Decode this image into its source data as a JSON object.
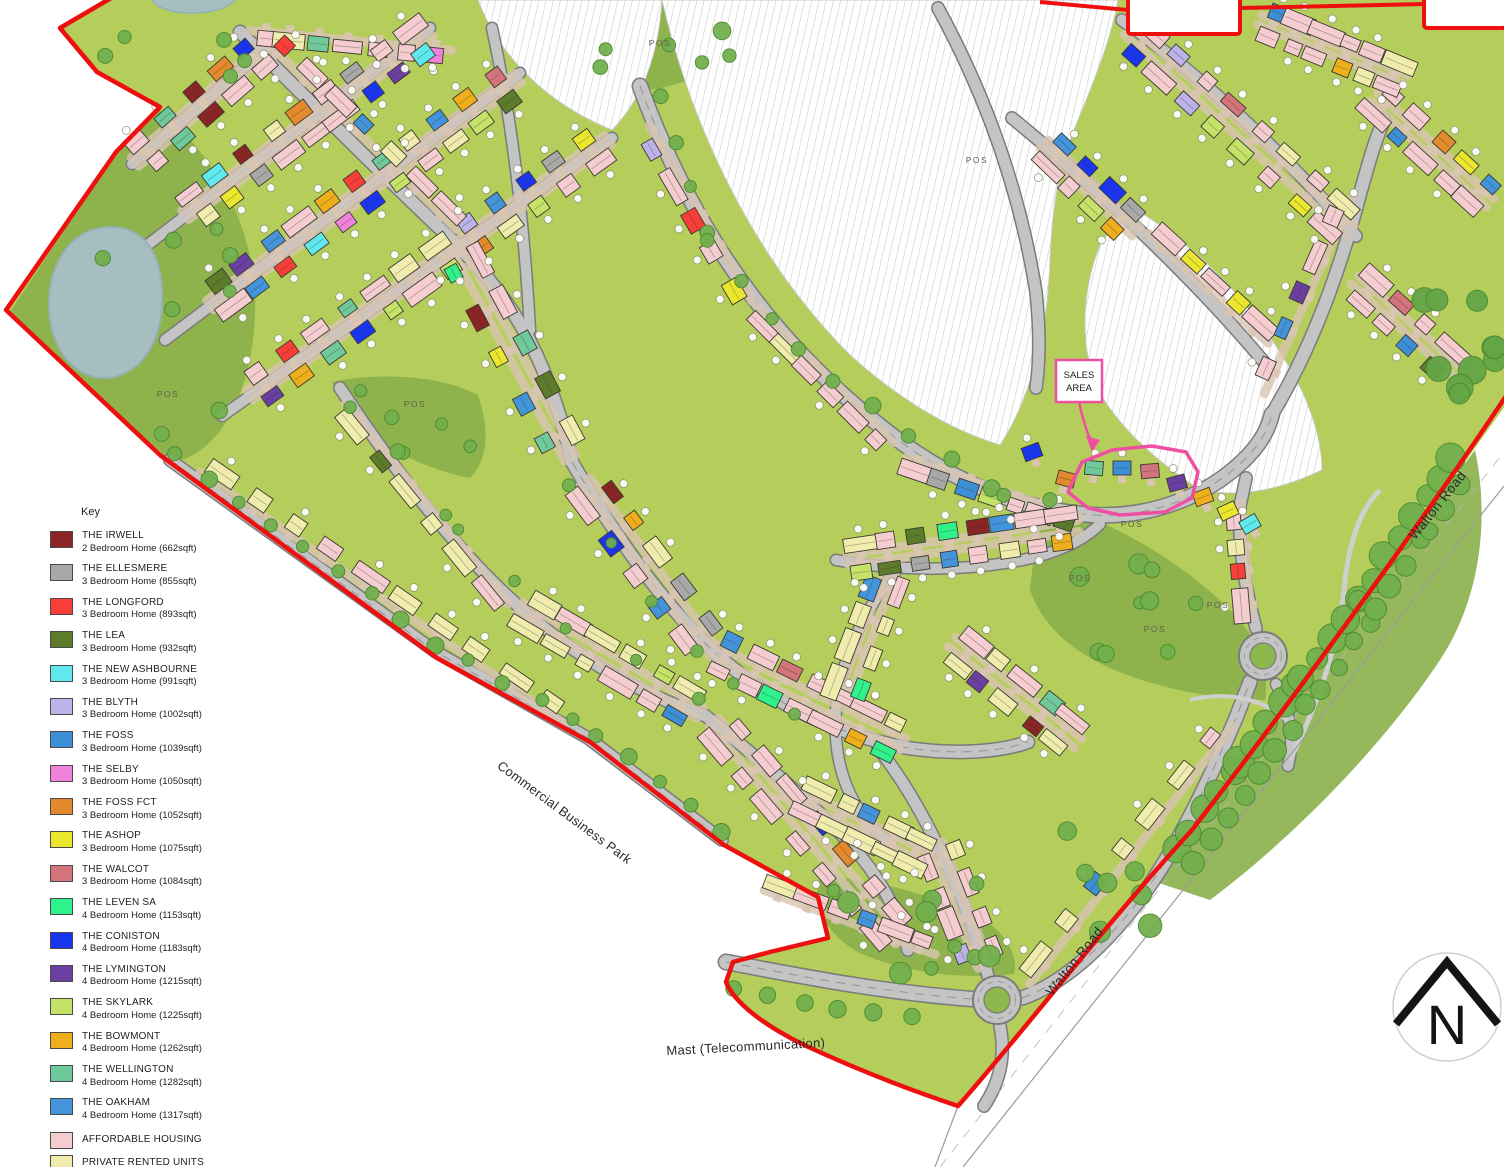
{
  "legend": {
    "title": "Key",
    "items": [
      {
        "name": "THE IRWELL",
        "desc": "2 Bedroom Home (662sqft)",
        "color": "#8b2424"
      },
      {
        "name": "THE ELLESMERE",
        "desc": "3 Bedroom Home (855sqft)",
        "color": "#a8a8a8"
      },
      {
        "name": "THE LONGFORD",
        "desc": "3 Bedroom Home (893sqft)",
        "color": "#f83e38"
      },
      {
        "name": "THE LEA",
        "desc": "3 Bedroom Home (932sqft)",
        "color": "#5d7c2b"
      },
      {
        "name": "THE NEW ASHBOURNE",
        "desc": "3 Bedroom Home (991sqft)",
        "color": "#5fe9ef"
      },
      {
        "name": "THE BLYTH",
        "desc": "3 Bedroom Home (1002sqft)",
        "color": "#bdb2e9"
      },
      {
        "name": "THE FOSS",
        "desc": "3 Bedroom Home (1039sqft)",
        "color": "#3c8ed6"
      },
      {
        "name": "THE SELBY",
        "desc": "3 Bedroom Home (1050sqft)",
        "color": "#ee82dc"
      },
      {
        "name": "THE FOSS FCT",
        "desc": "3 Bedroom Home (1052sqft)",
        "color": "#e4892d"
      },
      {
        "name": "THE ASHOP",
        "desc": "3 Bedroom Home (1075sqft)",
        "color": "#ebe72e"
      },
      {
        "name": "THE WALCOT",
        "desc": "3 Bedroom Home (1084sqft)",
        "color": "#d3737c"
      },
      {
        "name": "THE LEVEN SA",
        "desc": "4 Bedroom Home (1153sqft)",
        "color": "#2ff28c"
      },
      {
        "name": "THE CONISTON",
        "desc": "4 Bedroom Home (1183sqft)",
        "color": "#1a35f0"
      },
      {
        "name": "THE LYMINGTON",
        "desc": "4 Bedroom Home (1215sqft)",
        "color": "#6b3fa2"
      },
      {
        "name": "THE SKYLARK",
        "desc": "4 Bedroom Home (1225sqft)",
        "color": "#c6e369"
      },
      {
        "name": "THE BOWMONT",
        "desc": "4 Bedroom Home (1262sqft)",
        "color": "#efae1c"
      },
      {
        "name": "THE WELLINGTON",
        "desc": "4 Bedroom Home (1282sqft)",
        "color": "#6fc99b"
      },
      {
        "name": "THE OAKHAM",
        "desc": "4 Bedroom Home (1317sqft)",
        "color": "#4494dc"
      },
      {
        "name": "AFFORDABLE HOUSING",
        "desc": "",
        "color": "#f5cdd1"
      },
      {
        "name": "PRIVATE RENTED UNITS",
        "desc": "",
        "color": "#f0ecae"
      }
    ]
  },
  "labels": {
    "sales_area": "SALES AREA",
    "north": "N"
  },
  "map_labels": [
    {
      "id": "pos-1",
      "text": "POS",
      "x": 660,
      "y": 46,
      "rot": 0,
      "cls": "pos"
    },
    {
      "id": "pos-2",
      "text": "POS",
      "x": 977,
      "y": 163,
      "rot": 0,
      "cls": "pos"
    },
    {
      "id": "pos-3",
      "text": "POS",
      "x": 415,
      "y": 407,
      "rot": 0,
      "cls": "pos"
    },
    {
      "id": "pos-4",
      "text": "POS",
      "x": 168,
      "y": 397,
      "rot": 0,
      "cls": "pos"
    },
    {
      "id": "pos-5",
      "text": "POS",
      "x": 1132,
      "y": 527,
      "rot": 0,
      "cls": "pos"
    },
    {
      "id": "pos-6",
      "text": "POS",
      "x": 1080,
      "y": 581,
      "rot": 0,
      "cls": "pos"
    },
    {
      "id": "pos-7",
      "text": "POS",
      "x": 1218,
      "y": 608,
      "rot": 0,
      "cls": "pos"
    },
    {
      "id": "pos-8",
      "text": "POS",
      "x": 1155,
      "y": 632,
      "rot": 0,
      "cls": "pos"
    },
    {
      "id": "walton-road-label-1",
      "text": "Walton Road",
      "x": 1441,
      "y": 508,
      "rot": -51.5,
      "cls": "road"
    },
    {
      "id": "walton-road-label-2",
      "text": "Walton Road",
      "x": 1078,
      "y": 964,
      "rot": -51.5,
      "cls": "road"
    },
    {
      "id": "commercial-business-park-label",
      "text": "Commercial Business Park",
      "x": 562,
      "y": 816,
      "rot": 36.5,
      "cls": "place"
    },
    {
      "id": "mast-label",
      "text": "Mast (Telecommunication)",
      "x": 746,
      "y": 1051,
      "rot": -3,
      "cls": "place"
    }
  ],
  "colors": {
    "boundary": "#ee0f0f",
    "sales_outline": "#ef4fa3",
    "road_fill": "#c4c4c4",
    "road_edge": "#7b7b7b",
    "site_green": "#b5cd5a",
    "park_green": "#8ab04a",
    "pond": "#a7bec1",
    "tree": "#72b04d",
    "tan": "#d9c5b2"
  }
}
